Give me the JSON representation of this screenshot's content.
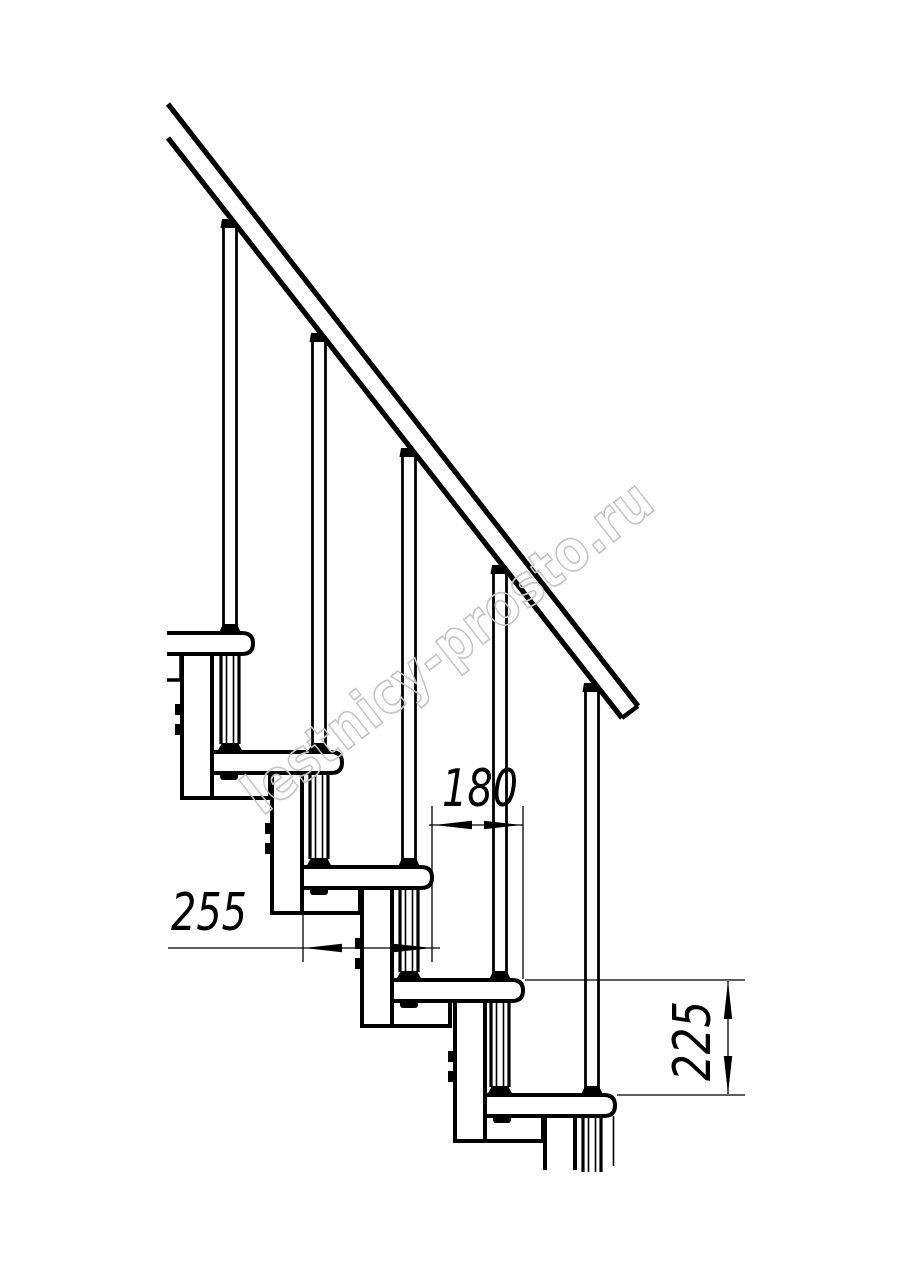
{
  "drawing": {
    "dimensions": {
      "run": "180",
      "depth": "255",
      "rise": "225"
    },
    "watermark": "lestnicy-prosto.ru",
    "colors": {
      "line": "#000000",
      "dimension_text": "#000000",
      "watermark_stroke": "#c5c5c5",
      "background": "#ffffff"
    }
  }
}
